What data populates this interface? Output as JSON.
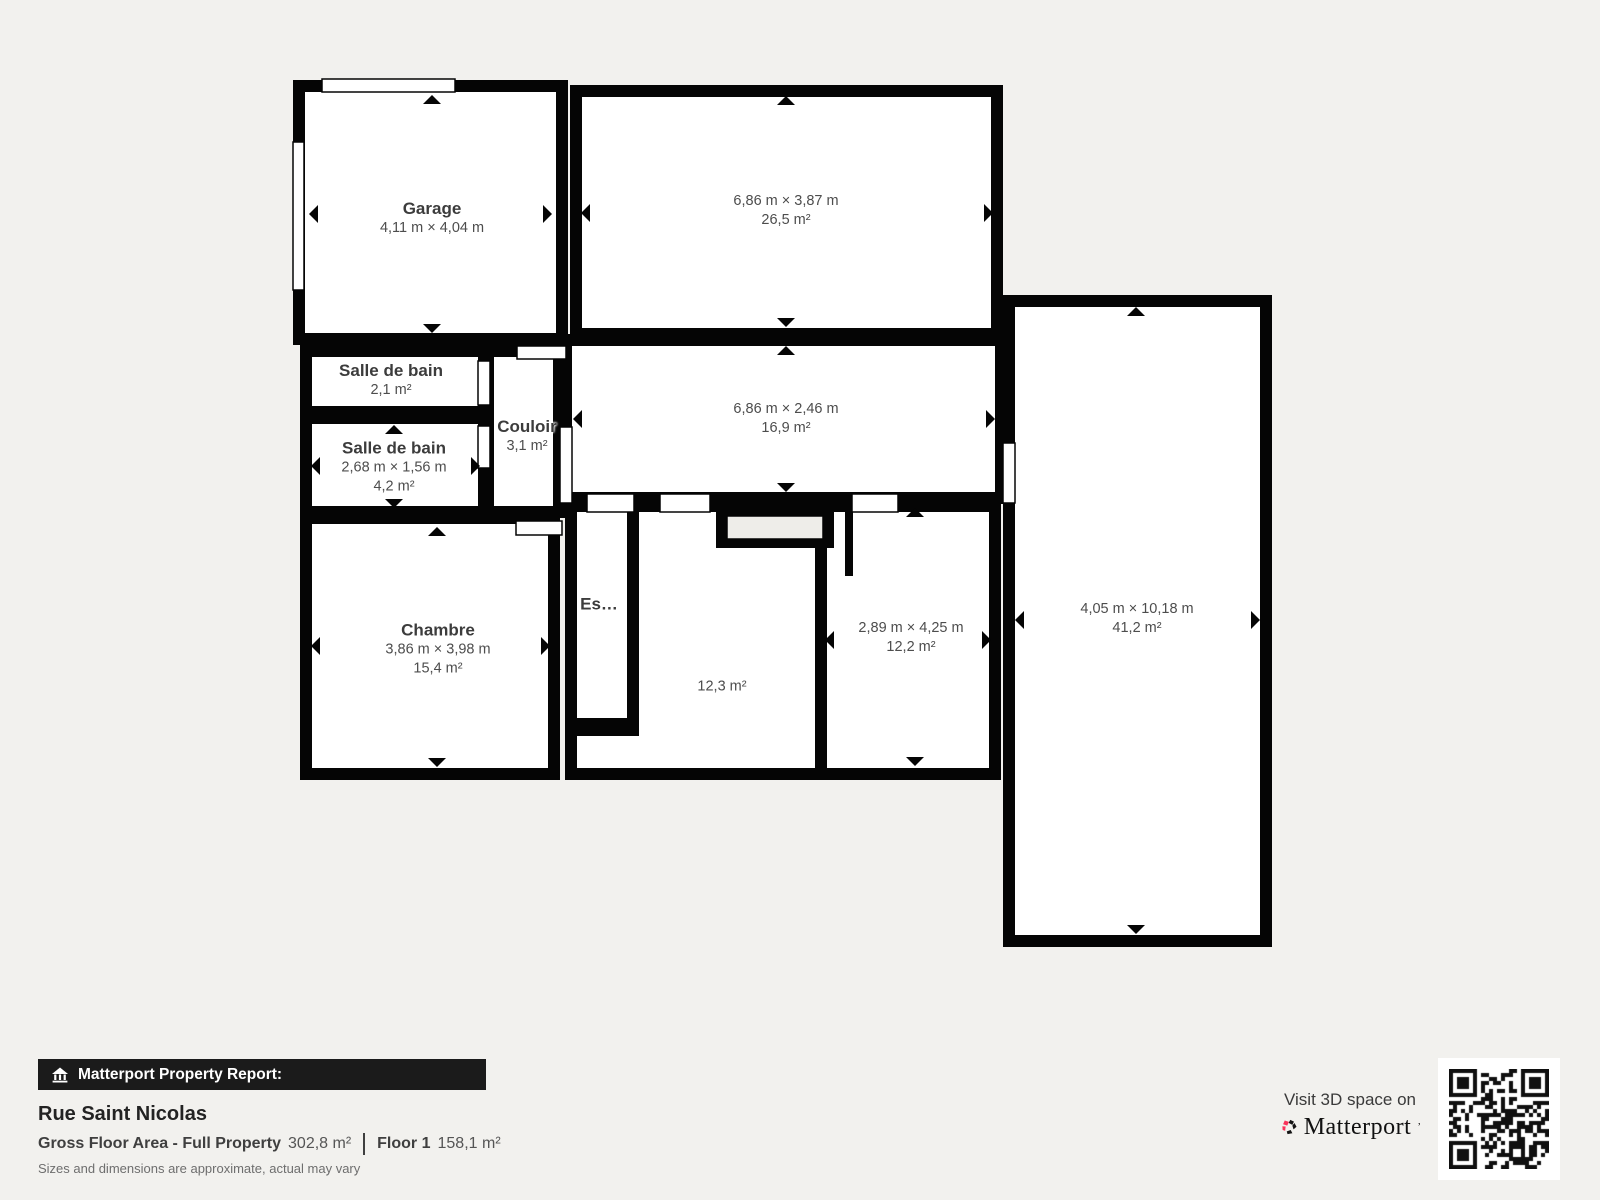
{
  "plan": {
    "rooms": {
      "garage": {
        "name": "Garage",
        "dims": "4,11 m × 4,04 m",
        "area": ""
      },
      "top_right": {
        "name": "",
        "dims": "6,86 m × 3,87 m",
        "area": "26,5 m²"
      },
      "bathroom_small": {
        "name": "Salle de bain",
        "dims": "",
        "area": "2,1 m²"
      },
      "bathroom": {
        "name": "Salle de bain",
        "dims": "2,68 m × 1,56 m",
        "area": "4,2 m²"
      },
      "hallway": {
        "name": "Couloir",
        "dims": "",
        "area": "3,1 m²"
      },
      "middle_right": {
        "name": "",
        "dims": "6,86 m × 2,46 m",
        "area": "16,9 m²"
      },
      "bedroom": {
        "name": "Chambre",
        "dims": "3,86 m × 3,98 m",
        "area": "15,4 m²"
      },
      "stairs": {
        "name": "Es…",
        "dims": "",
        "area": ""
      },
      "bottom_middle": {
        "name": "",
        "dims": "",
        "area": "12,3 m²"
      },
      "bottom_right": {
        "name": "",
        "dims": "2,89 m × 4,25 m",
        "area": "12,2 m²"
      },
      "right_wing": {
        "name": "",
        "dims": "4,05 m × 10,18 m",
        "area": "41,2 m²"
      }
    }
  },
  "report": {
    "badge_label": "Matterport Property Report:",
    "property_name": "Rue Saint Nicolas",
    "gfa_label": "Gross Floor Area - Full Property",
    "gfa_value": "302,8 m²",
    "floor_label": "Floor 1",
    "floor_value": "158,1 m²",
    "disclaimer": "Sizes and dimensions are approximate, actual may vary"
  },
  "cta": {
    "visit_text": "Visit 3D space on",
    "brand": "Matterport",
    "trademark": "’"
  },
  "colors": {
    "background": "#f2f1ee",
    "wall": "#050505",
    "room_fill": "#ffffff",
    "stair_fill": "#eeede9",
    "brand_red": "#f9325a",
    "badge_bg": "#1b1b1b"
  }
}
